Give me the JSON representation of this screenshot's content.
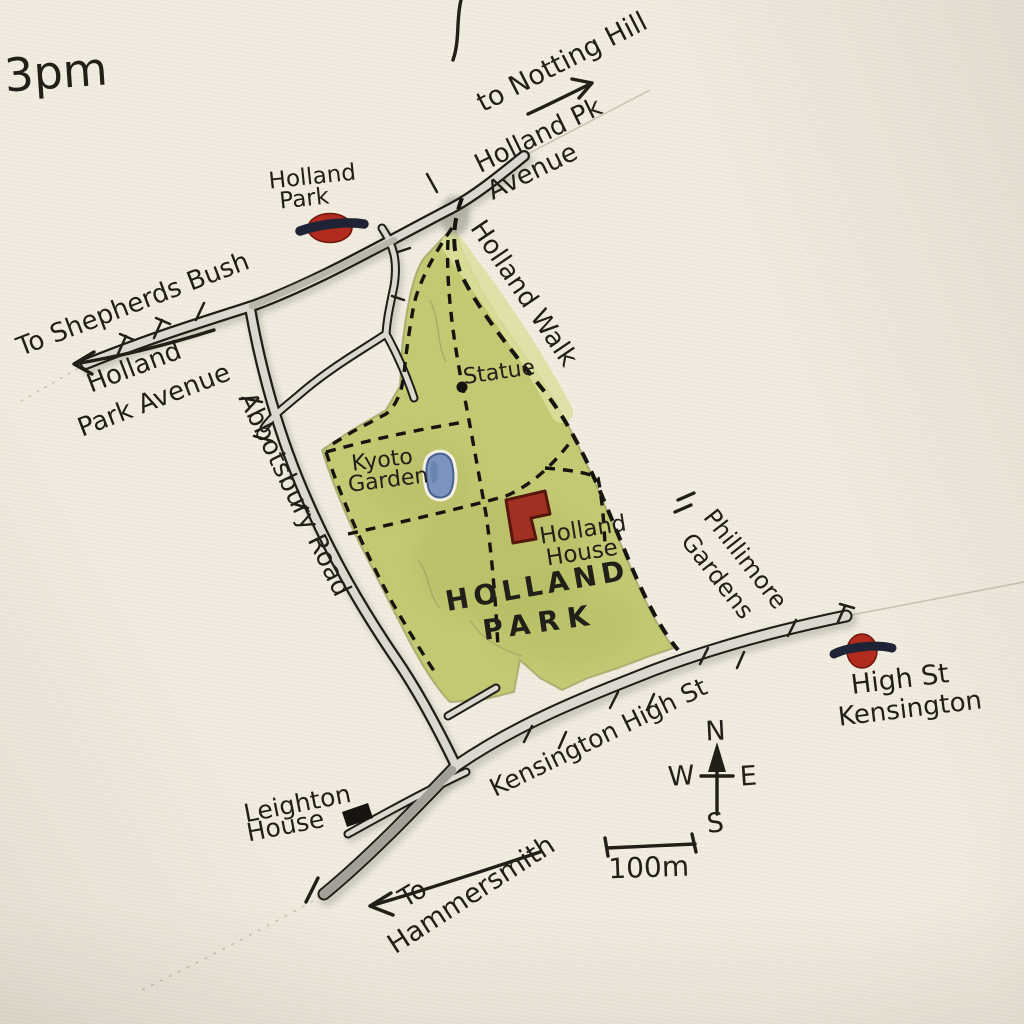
{
  "map": {
    "note_top_left": "3pm",
    "park": {
      "name_l1": "HOLLAND",
      "name_l2": "PARK"
    },
    "roads": {
      "holland_pk_avenue_l1": "Holland Pk",
      "holland_pk_avenue_l2": "Avenue",
      "holland_park_avenue_l1": "Holland",
      "holland_park_avenue_l2": "Park Avenue",
      "abbotsbury_road": "Abbotsbury Road",
      "holland_walk": "Holland Walk",
      "kensington_high_st": "Kensington High St",
      "phillimore_gardens_l1": "Phillimore",
      "phillimore_gardens_l2": "Gardens"
    },
    "directions": {
      "notting_hill": "to Notting Hill",
      "shepherds_bush": "To Shepherds Bush",
      "hammersmith_l1": "To",
      "hammersmith_l2": "Hammersmith"
    },
    "stations": {
      "holland_park_l1": "Holland",
      "holland_park_l2": "Park",
      "high_st_kensington_l1": "High St",
      "high_st_kensington_l2": "Kensington"
    },
    "pois": {
      "statue": "Statue",
      "kyoto_garden_l1": "Kyoto",
      "kyoto_garden_l2": "Garden",
      "holland_house_l1": "Holland",
      "holland_house_l2": "House",
      "leighton_house_l1": "Leighton",
      "leighton_house_l2": "House"
    },
    "compass": {
      "n": "N",
      "e": "E",
      "s": "S",
      "w": "W"
    },
    "scale": {
      "label": "100m"
    },
    "colors": {
      "paper": "#f1ecdf",
      "ink": "#221e18",
      "park_green": "#c3c873",
      "park_green_light": "#dcdf9e",
      "park_label_green": "#156a4e",
      "road_fill": "#dbd9cf",
      "road_dark": "#9b9990",
      "roundel_red": "#b12c1e",
      "roundel_bar": "#1e2436",
      "house_red": "#a03122",
      "pond_blue": "#7b93bd"
    }
  }
}
